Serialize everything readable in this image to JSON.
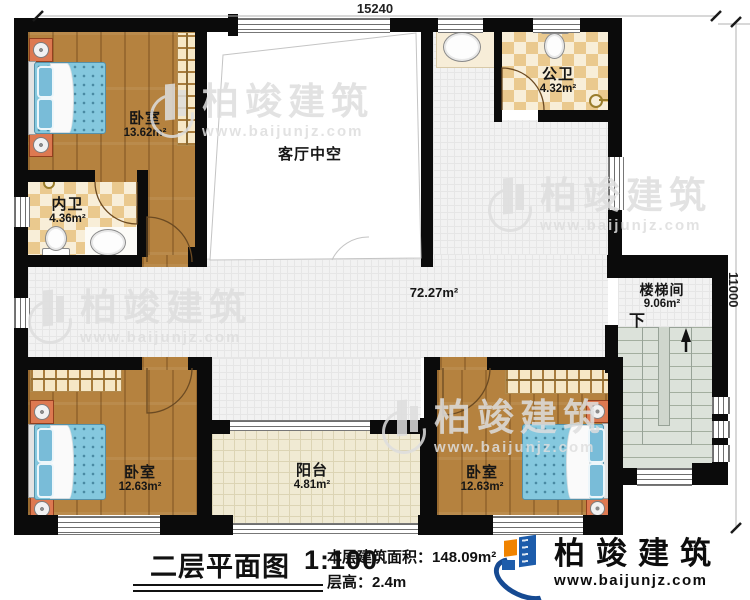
{
  "dimensions": {
    "top": "15240",
    "right": "11000"
  },
  "rooms": {
    "bedroom_tl": {
      "name": "卧室",
      "area": "13.62m²"
    },
    "bath_private": {
      "name": "内卫",
      "area": "4.36m²"
    },
    "living_void": {
      "name": "客厅中空"
    },
    "bath_public": {
      "name": "公卫",
      "area": "4.32m²"
    },
    "hallway": {
      "area": "72.27m²"
    },
    "stairwell": {
      "name": "楼梯间",
      "area": "9.06m²",
      "direction": "下"
    },
    "bedroom_bl": {
      "name": "卧室",
      "area": "12.63m²"
    },
    "balcony": {
      "name": "阳台",
      "area": "4.81m²"
    },
    "bedroom_br": {
      "name": "卧室",
      "area": "12.63m²"
    }
  },
  "title_block": {
    "title": "二层平面图",
    "scale": "1:100",
    "floor_area_label": "本层建筑面积：",
    "floor_area_value": "148.09m²",
    "floor_height_label": "层高：",
    "floor_height_value": "2.4m"
  },
  "brand": {
    "name": "柏竣建筑",
    "website": "www.baijunjz.com"
  },
  "watermark": {
    "name": "柏竣建筑",
    "website": "www.baijunjz.com"
  },
  "colors": {
    "wall": "#0b0b0b",
    "wood_floor": "#b5823f",
    "bath_checker": "#eac98e",
    "mattress_blue": "#85c8de",
    "logo_blue": "#1d5cab",
    "logo_orange": "#f08300"
  }
}
